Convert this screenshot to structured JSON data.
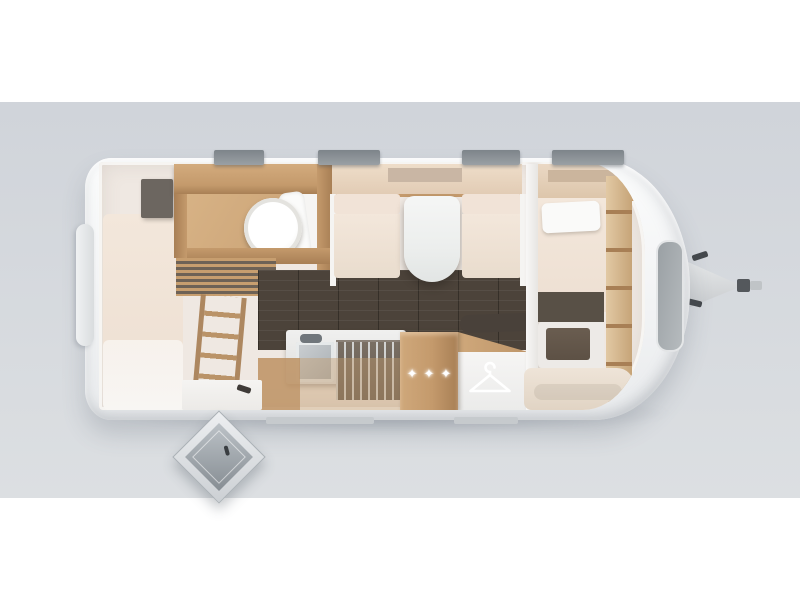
{
  "floorplan": {
    "type": "caravan-top-view-floorplan",
    "decor": {
      "star_glyph": "✦",
      "star_count": 3
    },
    "icons": {
      "star-icon": "✦",
      "clothes-hanger-icon": "hanger"
    },
    "features": [
      "rear-bed",
      "bunk-ladder",
      "washroom-with-toilet",
      "dinette-with-table",
      "kitchen-sink",
      "kitchen-stove",
      "wardrobe-with-stars",
      "hanger-closet",
      "front-bed",
      "front-bench",
      "entry-door-open",
      "tow-hitch"
    ],
    "counts": {
      "roof_windows": 4,
      "bottom_windows": 2,
      "front_windows": 1
    },
    "colors": {
      "page_bg": "#ffffff",
      "backdrop_top": "#d0d4da",
      "backdrop_bottom": "#dcdfe2",
      "body_white": "#f4f5f6",
      "interior_beige": "#efe8e2",
      "wood": "#c49a6c",
      "wood_light": "#dcc09a",
      "wood_dark": "#a87f55",
      "wood_floor_light": "#d7b285",
      "floor_dark": "#4c433a",
      "upholstery": "#f3e7db",
      "upholstery_deep": "#e9dccd",
      "linen_white": "#f8f6f3",
      "cabinet_dark": "#6c6660",
      "storage_brown": "#7b7166",
      "window_dark": "#9aa0a4",
      "window_light": "#c6cacd",
      "metal": "#a7adb1",
      "metal_dark": "#70767b",
      "seat_dark": "#5d5145",
      "table_white": "#eceeed",
      "star_white": "#ffffff"
    }
  }
}
